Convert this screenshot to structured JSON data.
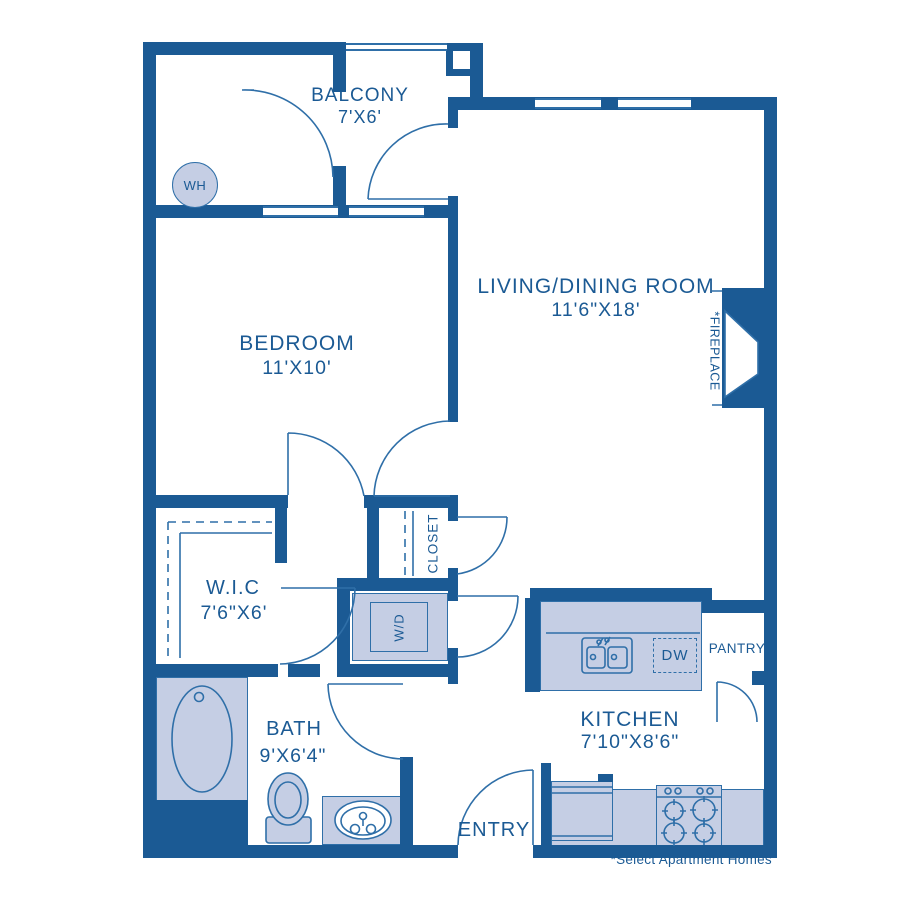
{
  "rooms": {
    "balcony": {
      "name": "BALCONY",
      "dims": "7'X6'"
    },
    "living": {
      "name": "LIVING/DINING ROOM",
      "dims": "11'6\"X18'"
    },
    "bedroom": {
      "name": "BEDROOM",
      "dims": "11'X10'"
    },
    "wic": {
      "name": "W.I.C",
      "dims": "7'6\"X6'"
    },
    "bath": {
      "name": "BATH",
      "dims": "9'X6'4\""
    },
    "kitchen": {
      "name": "KITCHEN",
      "dims": "7'10\"X8'6\""
    },
    "entry": {
      "name": "ENTRY"
    },
    "pantry": {
      "name": "PANTRY"
    },
    "closet": {
      "name": "CLOSET"
    }
  },
  "labels": {
    "water_heater": "WH",
    "washer_dryer": "W/D",
    "dishwasher": "DW",
    "fireplace": "*FIREPLACE"
  },
  "footnote": "*Select Apartment Homes",
  "colors": {
    "wall": "#1b5a94",
    "line": "#2f6fa8",
    "fill": "#c5cee4",
    "text": "#1b5a94"
  }
}
